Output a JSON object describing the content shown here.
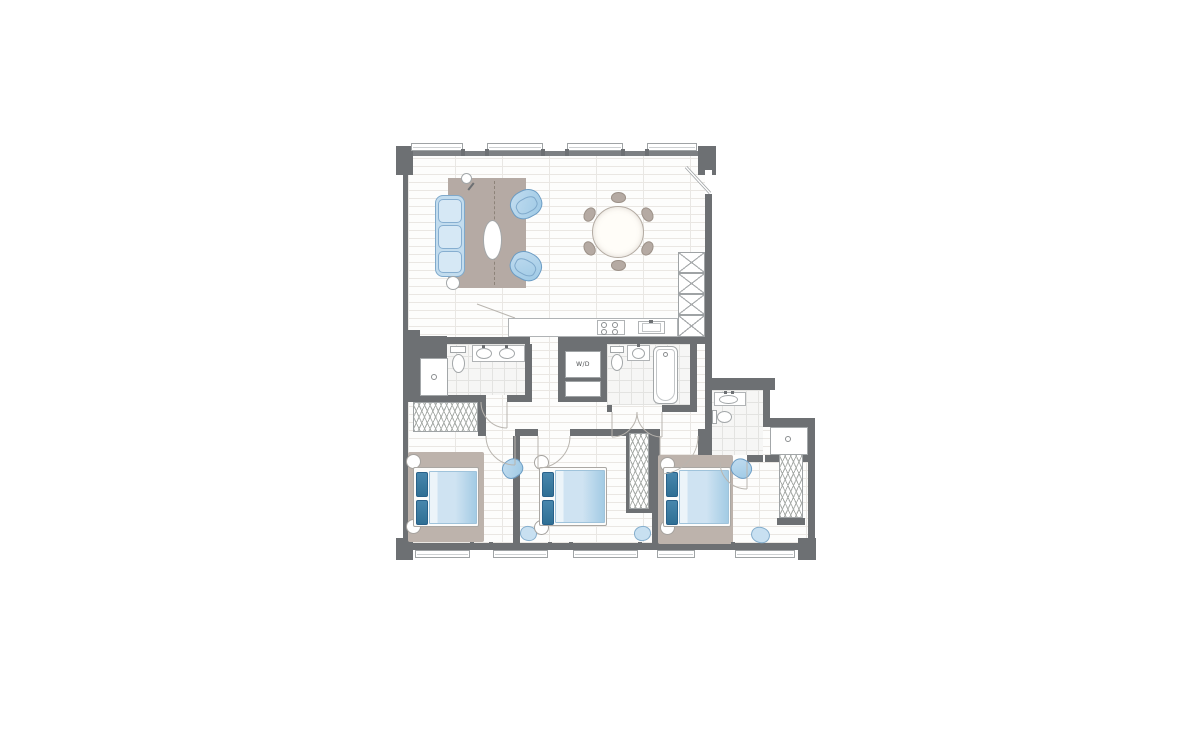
{
  "plan": {
    "labels": {
      "washer_dryer": "W/D"
    },
    "colors": {
      "wall": "#6d7073",
      "floor": "#fdfdfc",
      "floor_plank_line": "#eae7e3",
      "tile": "#f6f6f5",
      "tile_line": "#e3e3e1",
      "living_rug": "#b5aaa4",
      "bedroom_rug": "#bdb3ac",
      "sofa_blue": "#c2dcee",
      "armchair_blue": "#9dc9e5",
      "chair_outline_blue": "#6b9cc4",
      "pillow_dark_blue": "#2f6f94",
      "duvet_blue": "#cfe3f2",
      "dining_chair_taupe": "#b5aaa3",
      "fixture_outline": "#a3a7a9",
      "door_swing": "#b9b5af"
    },
    "icons": [
      "sofa",
      "armchair",
      "coffee-table",
      "floor-lamp",
      "side-table",
      "dining-table",
      "dining-chair",
      "cooktop",
      "kitchen-sink",
      "pantry-cabinet",
      "vanity-sink",
      "toilet",
      "shower",
      "shower-drain",
      "bathtub",
      "washer-dryer",
      "linen-cabinet",
      "bed",
      "nightstand",
      "pouf",
      "closet-hangers",
      "door-swing",
      "entry-door",
      "window"
    ]
  }
}
